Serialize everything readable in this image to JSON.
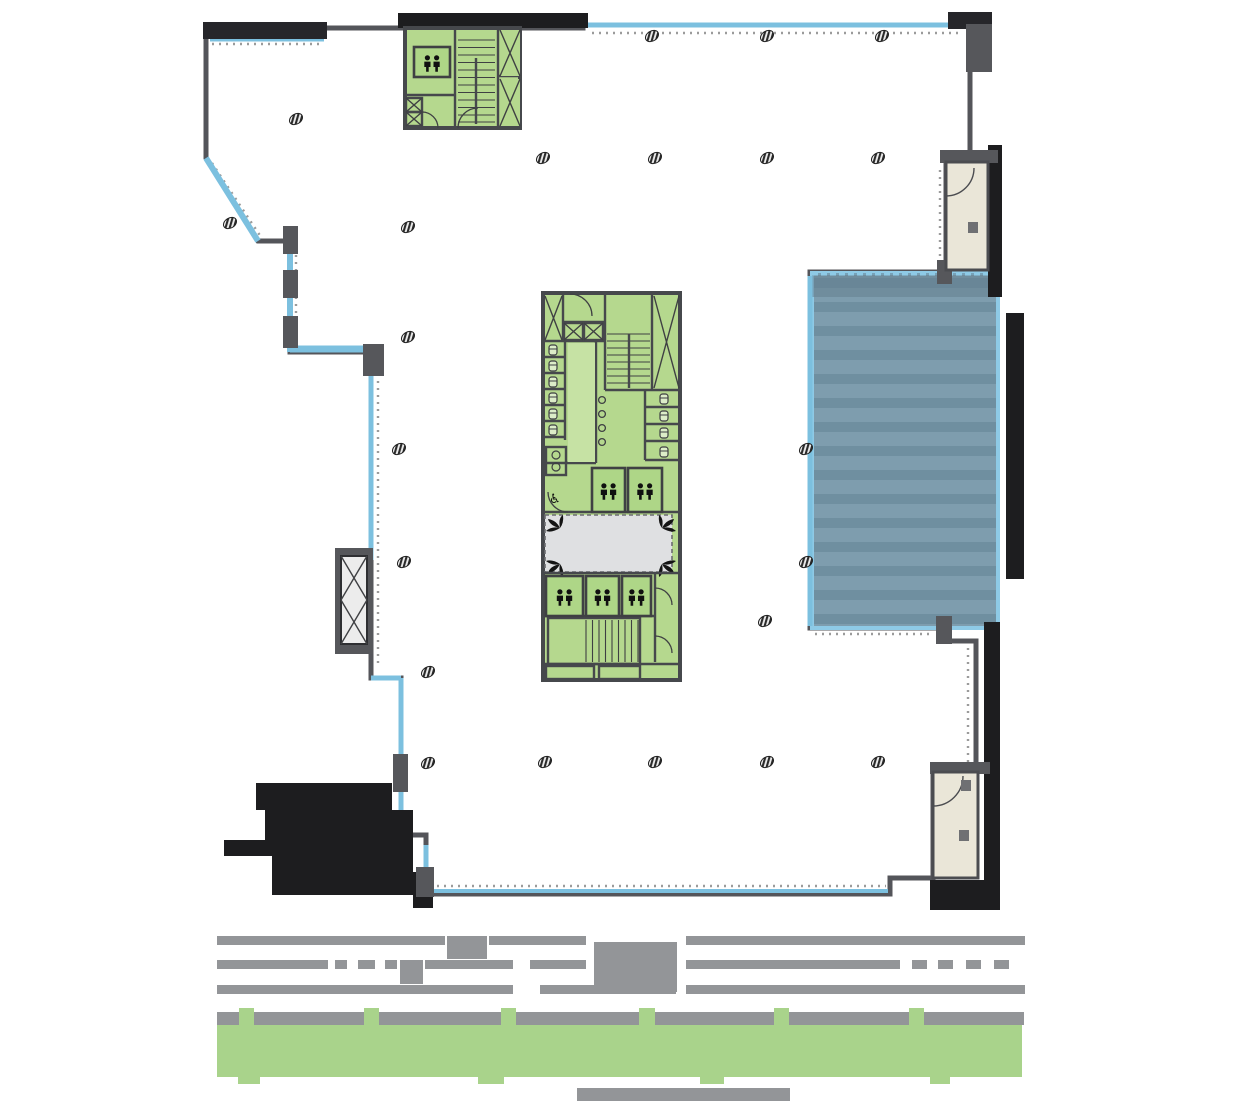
{
  "plan": {
    "accessible_symbol": "♿",
    "columns": [
      [
        652,
        36
      ],
      [
        767,
        36
      ],
      [
        882,
        36
      ],
      [
        296,
        119
      ],
      [
        543,
        158
      ],
      [
        655,
        158
      ],
      [
        767,
        158
      ],
      [
        878,
        158
      ],
      [
        230,
        223
      ],
      [
        408,
        227
      ],
      [
        408,
        337
      ],
      [
        399,
        449
      ],
      [
        806,
        449
      ],
      [
        404,
        562
      ],
      [
        806,
        562
      ],
      [
        765,
        621
      ],
      [
        428,
        672
      ],
      [
        428,
        763
      ],
      [
        545,
        762
      ],
      [
        655,
        762
      ],
      [
        767,
        762
      ],
      [
        878,
        762
      ]
    ],
    "elevators": [
      {
        "x": 414,
        "y": 47,
        "w": 36,
        "h": 30
      },
      {
        "x": 592,
        "y": 468,
        "w": 33,
        "h": 44
      },
      {
        "x": 628,
        "y": 468,
        "w": 34,
        "h": 44
      },
      {
        "x": 546,
        "y": 576,
        "w": 37,
        "h": 40
      },
      {
        "x": 586,
        "y": 576,
        "w": 33,
        "h": 40
      },
      {
        "x": 622,
        "y": 576,
        "w": 29,
        "h": 40
      }
    ]
  },
  "colors": {
    "floor": "#dfe0e2",
    "wall": "#54555a",
    "wall_dark": "#26262a",
    "outside_black": "#1d1d1f",
    "glass_blue": "#7cc0df",
    "core_green": "#b5d88e",
    "core_green_light": "#c6e2a4",
    "elevator_green": "#aed687",
    "terrace_blue_light": "#7e9dae",
    "terrace_blue_dark": "#6f8fa0",
    "balcony_beige": "#eae6d8",
    "redact_gray": "#939598",
    "redact_green": "#a9d38b"
  },
  "redaction": {
    "rows": [
      {
        "y": 936,
        "h": 9,
        "segments": [
          [
            217,
            228
          ],
          [
            489,
            97
          ],
          [
            686,
            339
          ]
        ]
      },
      {
        "y": 960,
        "h": 9,
        "segments": [
          [
            217,
            111
          ],
          [
            335,
            12
          ],
          [
            358,
            17
          ],
          [
            385,
            12
          ],
          [
            425,
            88
          ],
          [
            530,
            56
          ],
          [
            686,
            214
          ],
          [
            912,
            15
          ],
          [
            938,
            15
          ],
          [
            966,
            15
          ],
          [
            994,
            15
          ]
        ]
      },
      {
        "y": 985,
        "h": 9,
        "segments": [
          [
            217,
            296
          ],
          [
            540,
            136
          ],
          [
            686,
            339
          ]
        ]
      }
    ],
    "blocks": [
      [
        447,
        936,
        40,
        23
      ],
      [
        594,
        942,
        83,
        50
      ],
      [
        400,
        960,
        23,
        24
      ]
    ],
    "band_gray": {
      "x": 217,
      "y": 1012,
      "w": 807,
      "h": 13
    },
    "band_green": {
      "x": 217,
      "y": 1025,
      "w": 805,
      "h": 52
    },
    "green_bumps": [
      [
        239,
        1008,
        15,
        17
      ],
      [
        364,
        1008,
        15,
        17
      ],
      [
        501,
        1008,
        15,
        17
      ],
      [
        639,
        1008,
        16,
        17
      ],
      [
        774,
        1008,
        15,
        17
      ],
      [
        909,
        1008,
        15,
        17
      ]
    ],
    "green_descenders": [
      [
        238,
        1076,
        22,
        8
      ],
      [
        478,
        1076,
        26,
        8
      ],
      [
        700,
        1076,
        24,
        8
      ],
      [
        930,
        1076,
        20,
        8
      ]
    ],
    "bottom_bar": {
      "x": 577,
      "y": 1088,
      "w": 213,
      "h": 13
    }
  }
}
